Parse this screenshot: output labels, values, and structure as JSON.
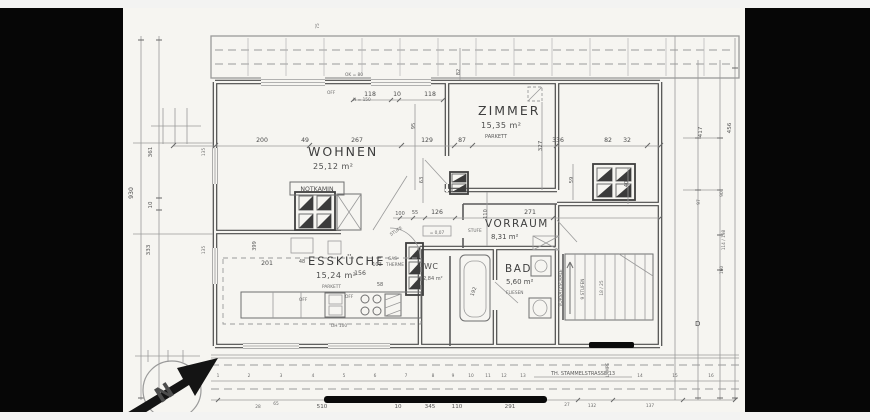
{
  "rooms": {
    "wohnen": {
      "name": "WOHNEN",
      "area": "25,12 m²"
    },
    "zimmer": {
      "name": "ZIMMER",
      "area": "15,35 m²",
      "floor": "PARKETT"
    },
    "esskueche": {
      "name": "ESSKÜCHE",
      "area": "15,24 m²",
      "floor": "PARKETT"
    },
    "vorraum": {
      "name": "VORRAUM",
      "area": "8,31 m²"
    },
    "bad": {
      "name": "BAD",
      "area": "5,60 m²",
      "floor": "FLIESEN"
    },
    "wc": {
      "name": "WC",
      "area": "2,84 m²"
    }
  },
  "annotations": {
    "notkamin": "NOTKAMIN",
    "gas1": "GAS-",
    "gas2": "THERME",
    "stufe_a": "STUFE",
    "stufe_b": "STUFE",
    "vorsatzschale": "VORSATZSCHALE",
    "stufen": "9 STUFEN",
    "stg": "18 / 25",
    "lampe": "LAMPE",
    "d_mark": "D",
    "off_roof": "OFF",
    "ok80": "OK = 80",
    "h150": "H = 150",
    "off_k1": "OFF",
    "off_k2": "OFF",
    "dh100": "DH 100",
    "level": "= 0,07"
  },
  "street_label": "TH. STAMMELSTRASSE 13",
  "compass_letter": "N",
  "dims": {
    "top": [
      "200",
      "49",
      "267",
      "129",
      "87",
      "336",
      "82",
      "32"
    ],
    "win": [
      "118",
      "10",
      "118"
    ],
    "left": [
      "930",
      "361",
      "10",
      "333",
      "135",
      "135"
    ],
    "right": [
      "417",
      "456",
      "97",
      "90",
      "114 / 198",
      "160"
    ],
    "mid": [
      "100",
      "55",
      "126",
      "271"
    ],
    "kitchen": [
      "201",
      "48",
      "156",
      "103",
      "58",
      "399"
    ],
    "vert": [
      "82",
      "95",
      "327",
      "63",
      "110",
      "59",
      "40",
      "192",
      "75"
    ],
    "bottom": [
      "510",
      "10",
      "345",
      "110",
      "291",
      "132",
      "137"
    ],
    "bottom_small": [
      "28",
      "65",
      "27"
    ],
    "ticks": [
      "1",
      "2",
      "3",
      "4",
      "5",
      "6",
      "7",
      "8",
      "9",
      "10",
      "11",
      "12",
      "13",
      "14",
      "15",
      "16"
    ]
  }
}
